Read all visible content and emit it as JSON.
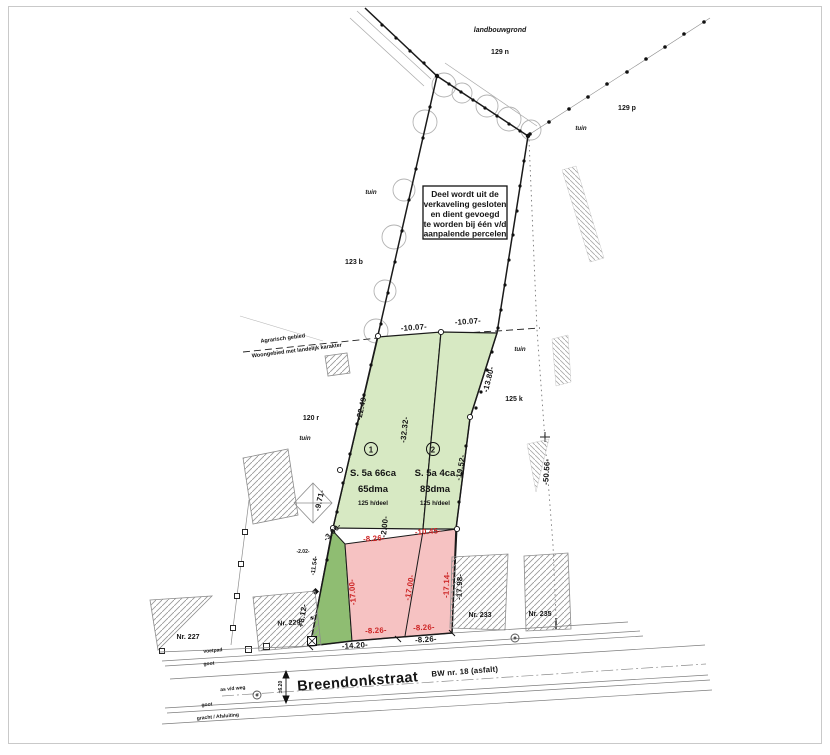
{
  "plan": {
    "note_box": {
      "line1": "Deel wordt uit de",
      "line2": "verkaveling gesloten",
      "line3": "en dient gevoegd",
      "line4": "te worden bij één v/d",
      "line5": "aanpalende percelen"
    },
    "zone_boundary": {
      "upper": "Agrarisch gebied",
      "lower": "Woongebied met landelijk karakter"
    },
    "adjacent_parcels": {
      "landbouwgrond": "landbouwgrond",
      "p129n": "129 n",
      "p129p": "129 p",
      "tuin": "tuin",
      "p123b": "123 b",
      "p120r": "120 r",
      "p125k": "125 k"
    },
    "houses": {
      "nr227": "Nr. 227",
      "nr229": "Nr. 229",
      "nr233": "Nr. 233",
      "nr235": "Nr. 235"
    },
    "lots": [
      {
        "id": "1",
        "surface": "S. 5a 66ca",
        "surface_extra": "65dma",
        "note": "125 h/deel"
      },
      {
        "id": "2",
        "surface": "S. 5a 4ca",
        "surface_extra": "83dma",
        "note": "125 h/deel"
      }
    ],
    "measurements": {
      "top_left": "-10.07-",
      "top_right": "-10.07-",
      "left_upper": "-22.49-",
      "divider": "-32.32-",
      "right_upper": "-13.80-",
      "right_lower": "-19.52-",
      "right_dotted": "-50.56-",
      "left_lower": "-9.71-",
      "corner": "-3.00-",
      "divider_gap": "-2.00-",
      "tie": "-2.02-",
      "left_b1": "-11.54-",
      "left_b2": "+8.12-",
      "pink_top_left": "-8.26-",
      "pink_top_right": "-10.45-",
      "pink_left": "-17.00-",
      "pink_mid": "-17.00-",
      "pink_right": "-17.14-",
      "pink_right_black": "-17.98-",
      "pink_bottom_left": "-8.26-",
      "pink_bottom_right": "-8.26-",
      "frontage_left": "-14.20-",
      "frontage_right": "-8.26-"
    },
    "street": {
      "name": "Breendonkstraat",
      "road_ref": "BW nr. 18 (asfalt)",
      "sidewalk": "voetpad",
      "gutter_top": "goot",
      "axis": "as v/d weg",
      "road_width": "±6.20",
      "gutter_bottom": "goot",
      "ditch": "gracht / Afsluiting"
    },
    "colors": {
      "lot_green": "#d7e9c3",
      "excluded_green": "#8fbd72",
      "strip_pink": "#f6c2c2",
      "red_text": "#cc2222",
      "line_black": "#1a1a1a",
      "line_gray": "#9a9a9a"
    }
  }
}
